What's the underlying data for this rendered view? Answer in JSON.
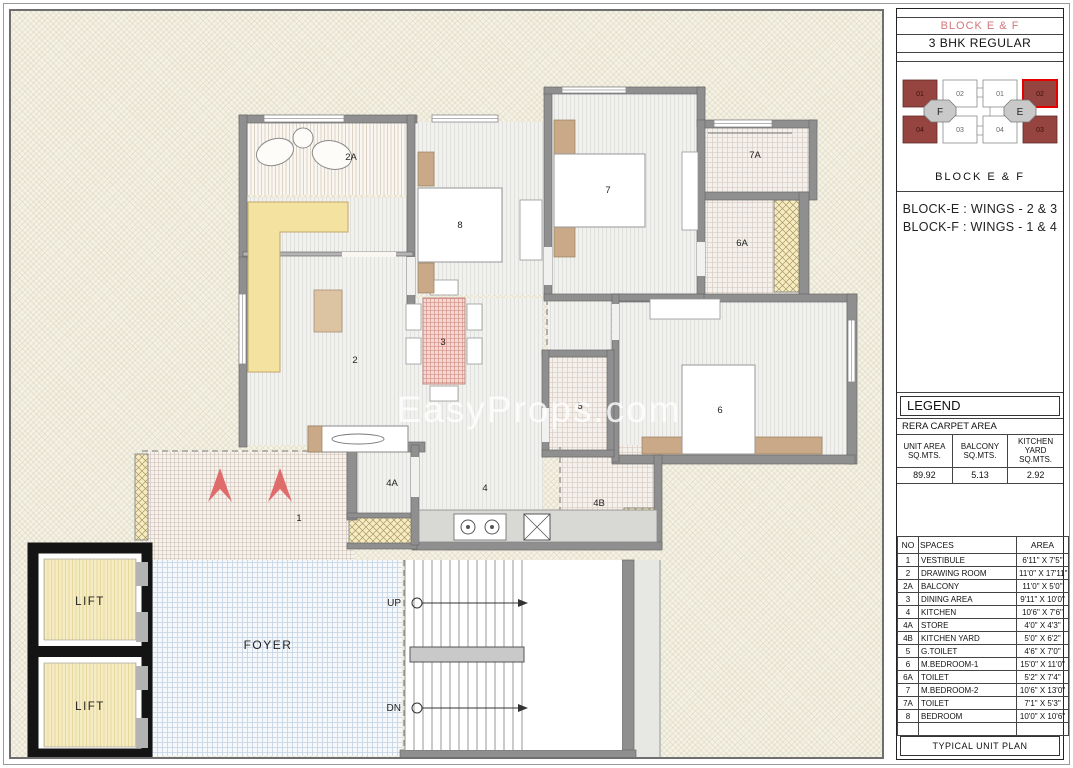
{
  "header": {
    "block_title": "BLOCK E & F",
    "unit_type": "3 BHK REGULAR"
  },
  "keyplan": {
    "caption": "BLOCK  E & F",
    "wings": [
      {
        "core": "F",
        "units": {
          "u01": "01",
          "u02": "02",
          "u03": "03",
          "u04": "04"
        }
      },
      {
        "core": "E",
        "units": {
          "u01": "01",
          "u02": "02",
          "u03": "03",
          "u04": "04"
        }
      }
    ]
  },
  "wings_note": [
    "BLOCK-E : WINGS - 2 & 3",
    "BLOCK-F : WINGS - 1 & 4"
  ],
  "legend": {
    "title": "LEGEND",
    "subtitle": "RERA CARPET AREA",
    "columns": [
      "UNIT AREA SQ.MTS.",
      "BALCONY SQ.MTS.",
      "KITCHEN YARD SQ.MTS."
    ],
    "values": [
      "89.92",
      "5.13",
      "2.92"
    ]
  },
  "spaces_table": {
    "headers": [
      "NO",
      "SPACES",
      "AREA"
    ],
    "rows": [
      {
        "no": "1",
        "space": "VESTIBULE",
        "area": "6'11\" X 7'5\""
      },
      {
        "no": "2",
        "space": "DRAWING ROOM",
        "area": "11'0\" X 17'11\""
      },
      {
        "no": "2A",
        "space": "BALCONY",
        "area": "11'0\" X 5'0\""
      },
      {
        "no": "3",
        "space": "DINING AREA",
        "area": "9'11\" X 10'0\""
      },
      {
        "no": "4",
        "space": "KITCHEN",
        "area": "10'6\" X 7'6\""
      },
      {
        "no": "4A",
        "space": "STORE",
        "area": "4'0\" X 4'3\""
      },
      {
        "no": "4B",
        "space": "KITCHEN YARD",
        "area": "5'0\" X 6'2\""
      },
      {
        "no": "5",
        "space": "G.TOILET",
        "area": "4'6\" X 7'0\""
      },
      {
        "no": "6",
        "space": "M.BEDROOM-1",
        "area": "15'0\" X 11'0\""
      },
      {
        "no": "6A",
        "space": "TOILET",
        "area": "5'2\" X 7'4\""
      },
      {
        "no": "7",
        "space": "M.BEDROOM-2",
        "area": "10'6\" X 13'0\""
      },
      {
        "no": "7A",
        "space": "TOILET",
        "area": "7'1\" X 5'3\""
      },
      {
        "no": "8",
        "space": "BEDROOM",
        "area": "10'0\" X 10'6\""
      }
    ]
  },
  "footer": "TYPICAL UNIT PLAN",
  "plan": {
    "watermark": "EasyProps.com",
    "room_labels": {
      "r1": "1",
      "r2": "2",
      "r2a": "2A",
      "r3": "3",
      "r4": "4",
      "r4a": "4A",
      "r4b": "4B",
      "r5": "5",
      "r6": "6",
      "r6a": "6A",
      "r7": "7",
      "r7a": "7A",
      "r8": "8"
    },
    "lift_label": "LIFT",
    "foyer_label": "FOYER",
    "up_label": "UP",
    "dn_label": "DN"
  },
  "colors": {
    "title_red": "#d4767a",
    "keyplan_unit_maroon": "#96443f",
    "keyplan_selected_outline": "#e60000",
    "keyplan_core_gray": "#c9c9c9",
    "wall_gray": "#8f8f8f",
    "lift_wall_black": "#141414",
    "shaft_yellow": "#f6ecc3",
    "sofa_yellow": "#f4e2a0",
    "wardrobe_tan": "#c9a987",
    "dining_red": "#dc9a90",
    "entry_arrow_red": "#e06b6b",
    "foyer_grid_blue": "#c4d2e2",
    "sheet_cream": "#f4f1e5"
  }
}
